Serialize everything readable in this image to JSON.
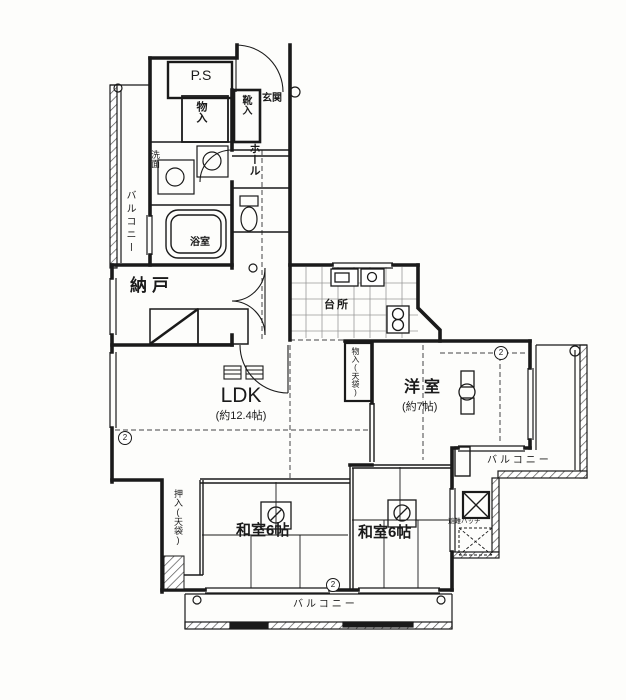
{
  "doc": {
    "type": "apartment-floor-plan"
  },
  "colors": {
    "ink": "#1a1a1a",
    "paper": "#fdfdfb",
    "tile_line": "#999999"
  },
  "rooms": {
    "ps": "P.S",
    "storage_top": "物入",
    "shoe_box": "靴入",
    "entrance": "玄関",
    "hall": "ホール",
    "washroom": "洗面",
    "bathroom": "浴室",
    "storeroom": "納戸",
    "kitchen": "台所",
    "ldk": "LDK",
    "ldk_size": "(約12.4帖)",
    "closet_tenbukuro": "物入(天袋)",
    "western_room": "洋室",
    "western_room_size": "(約7帖)",
    "japanese_room_left": "和室6帖",
    "japanese_room_right": "和室6帖",
    "oshiire": "押入(天袋)",
    "balcony_left": "バルコニー",
    "balcony_right": "バルコニー",
    "balcony_bottom": "バルコニー",
    "escape_hatch": "避難ハッチ"
  },
  "markers": {
    "two": "2"
  }
}
